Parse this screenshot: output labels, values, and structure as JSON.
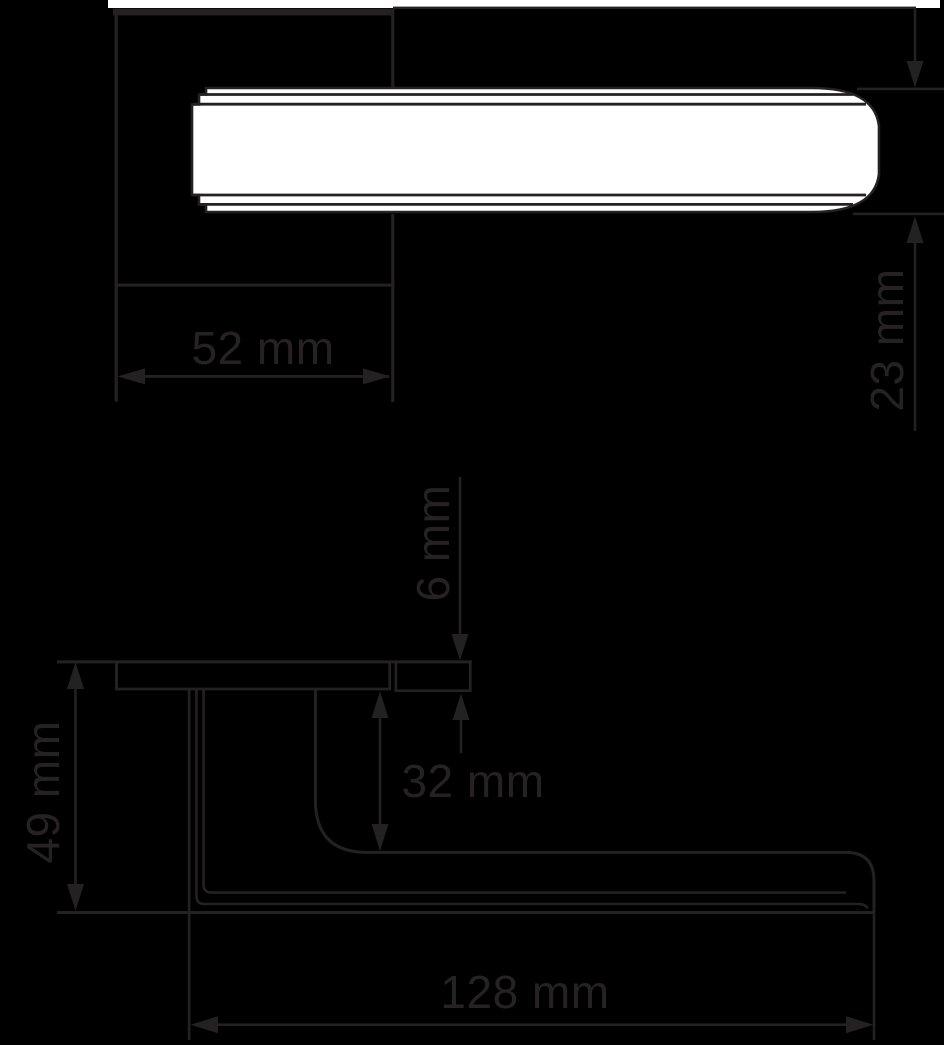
{
  "drawing": {
    "type": "technical-dimension-drawing",
    "subject": "door-lever-handle",
    "colors": {
      "background": "#000000",
      "line": "#242122",
      "label": "#262223",
      "handle_fill": "#ffffff",
      "top_strip": "#ffffff"
    },
    "views": {
      "top_view": {
        "dimensions": {
          "rosette_width": {
            "label": "52 mm"
          },
          "handle_thickness": {
            "label": "23 mm"
          }
        }
      },
      "side_view": {
        "dimensions": {
          "rosette_thickness": {
            "label": "6 mm"
          },
          "neck_clearance": {
            "label": "32 mm"
          },
          "total_projection": {
            "label": "49 mm"
          },
          "lever_length": {
            "label": "128 mm"
          }
        }
      }
    }
  }
}
